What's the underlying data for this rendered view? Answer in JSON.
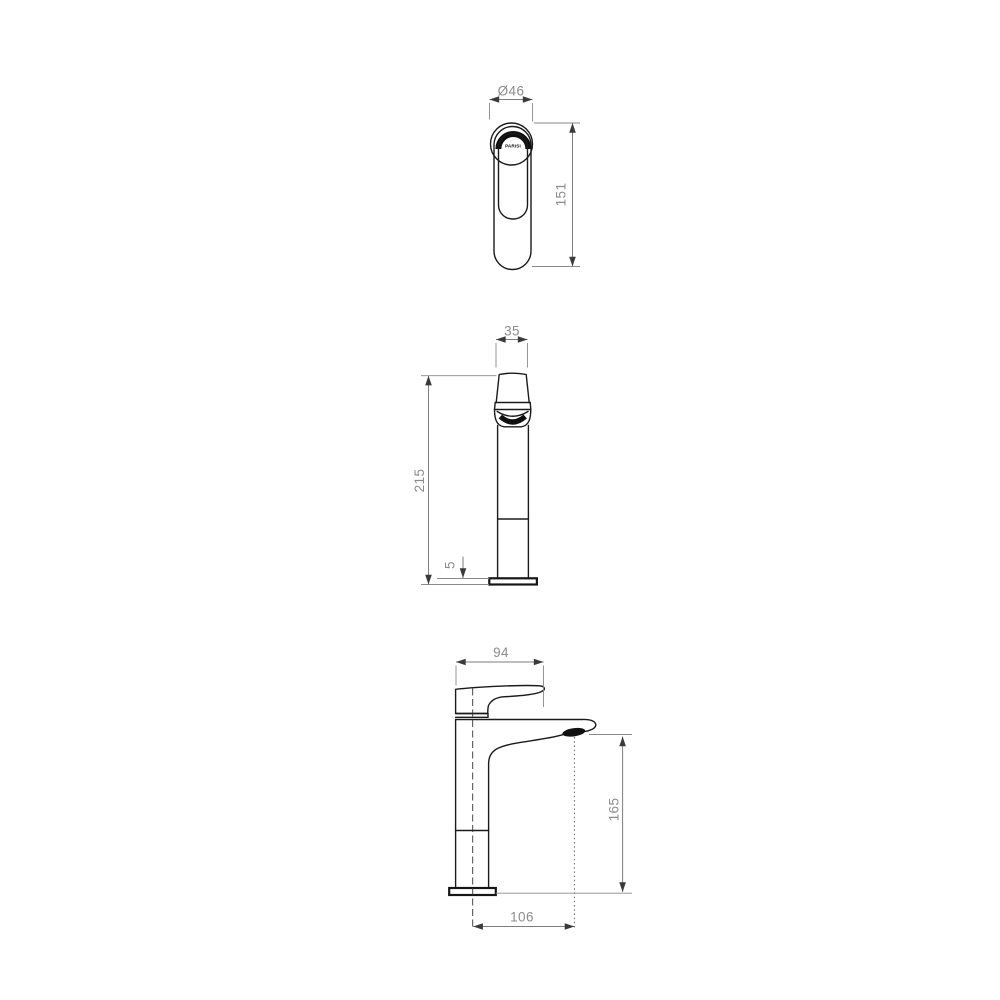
{
  "meta": {
    "description": "Technical dimension drawing of a tall basin mixer tap, three orthographic views",
    "background_color": "#ffffff",
    "object_line_color": "#1b1b1b",
    "dimension_line_color": "#7d7d7d",
    "text_color": "#8c8c8c"
  },
  "brand": {
    "logo": "PARISI"
  },
  "views": {
    "top": {
      "diameter": "Ø46",
      "overall_length": "151"
    },
    "front": {
      "body_width": "35",
      "overall_height": "215",
      "base_plate_thickness": "5"
    },
    "side": {
      "handle_reach": "94",
      "outlet_height": "165",
      "outlet_reach": "106"
    }
  }
}
